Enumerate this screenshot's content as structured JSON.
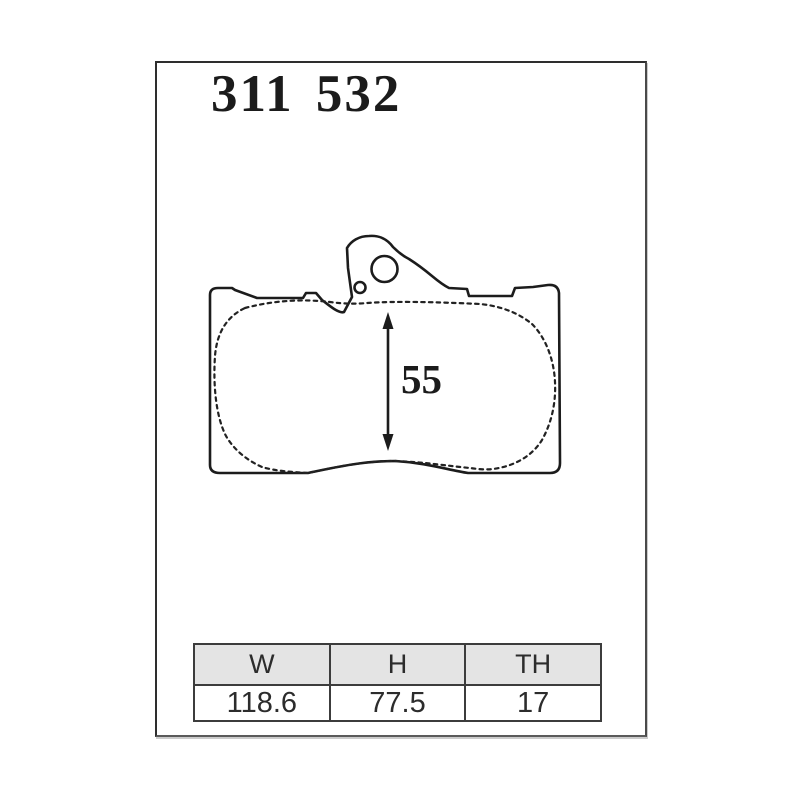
{
  "part_number": "311 532",
  "diagram": {
    "description": "brake-pad-outline-drawing",
    "dimension_label": "55"
  },
  "spec_table": {
    "headers": [
      "W",
      "H",
      "TH"
    ],
    "values": [
      "118.6",
      "77.5",
      "17"
    ]
  },
  "colors": {
    "background": "#ffffff",
    "line": "#1c1c1c",
    "frame_border": "#2e2e2e",
    "table_border": "#3c3c3c",
    "table_header_bg": "#e4e4e4",
    "text": "#2c2c2c"
  }
}
